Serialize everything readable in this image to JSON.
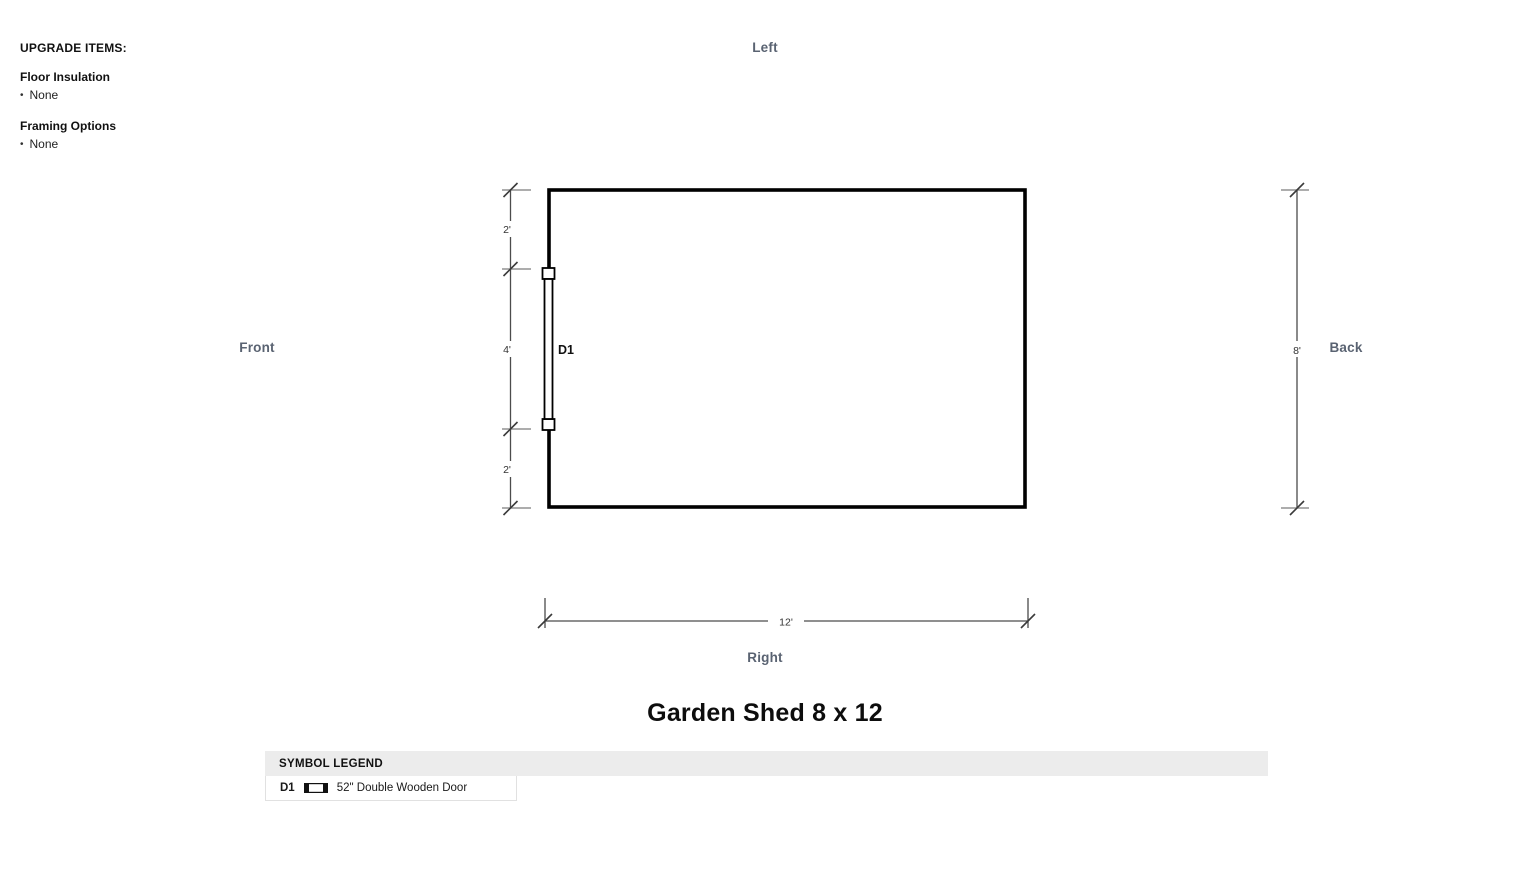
{
  "upgrade": {
    "title": "UPGRADE ITEMS:",
    "items": [
      {
        "label": "Floor Insulation",
        "value": "None"
      },
      {
        "label": "Framing Options",
        "value": "None"
      }
    ]
  },
  "plan": {
    "side_labels": {
      "top": "Left",
      "left": "Front",
      "right": "Back",
      "bottom": "Right"
    },
    "door": {
      "label": "D1"
    },
    "dimensions": {
      "left_segments": [
        "2'",
        "4'",
        "2'"
      ],
      "height_total": "8'",
      "width_total": "12'"
    }
  },
  "title": "Garden Shed 8 x 12",
  "legend": {
    "header": "SYMBOL LEGEND",
    "rows": [
      {
        "code": "D1",
        "symbol": "double-door-icon",
        "description": "52\" Double Wooden Door"
      }
    ]
  },
  "colors": {
    "side_label": "#5a6372",
    "wall": "#000000",
    "dim_line": "#4c4c4c",
    "extension_line": "#929292",
    "slash": "#3a3a3a",
    "legend_header_bg": "#ececec"
  }
}
